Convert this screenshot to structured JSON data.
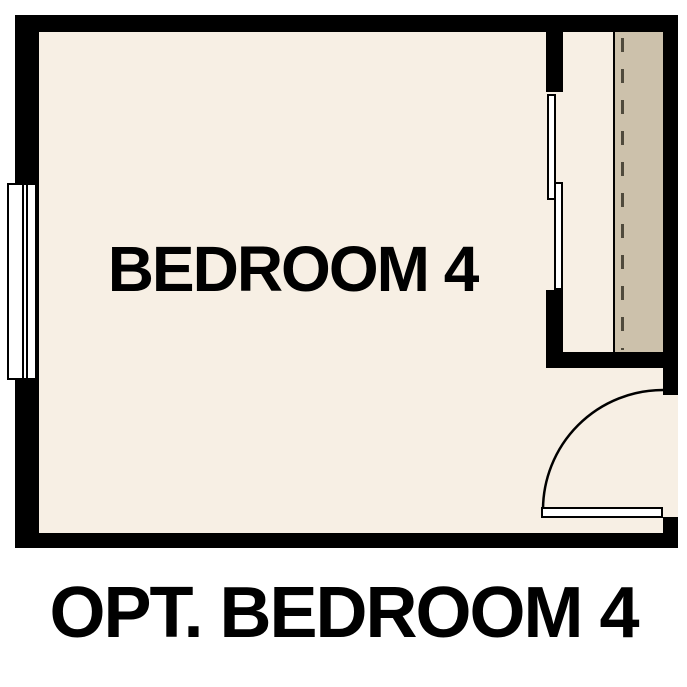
{
  "plan": {
    "room_label": "BEDROOM 4",
    "features": {
      "window": "window",
      "closet_bypass_doors": "sliding bypass doors",
      "closet_shelf_line": "dashed shelf line",
      "door_swing": "quarter-circle door swing"
    }
  },
  "caption": "OPT. BEDROOM 4",
  "colors": {
    "wall": "#000000",
    "floor": "#f7efe4",
    "shelf": "#ccc1ab",
    "dash": "#4f4a3c",
    "fixture": "#ffffff",
    "ink": "#000000"
  }
}
